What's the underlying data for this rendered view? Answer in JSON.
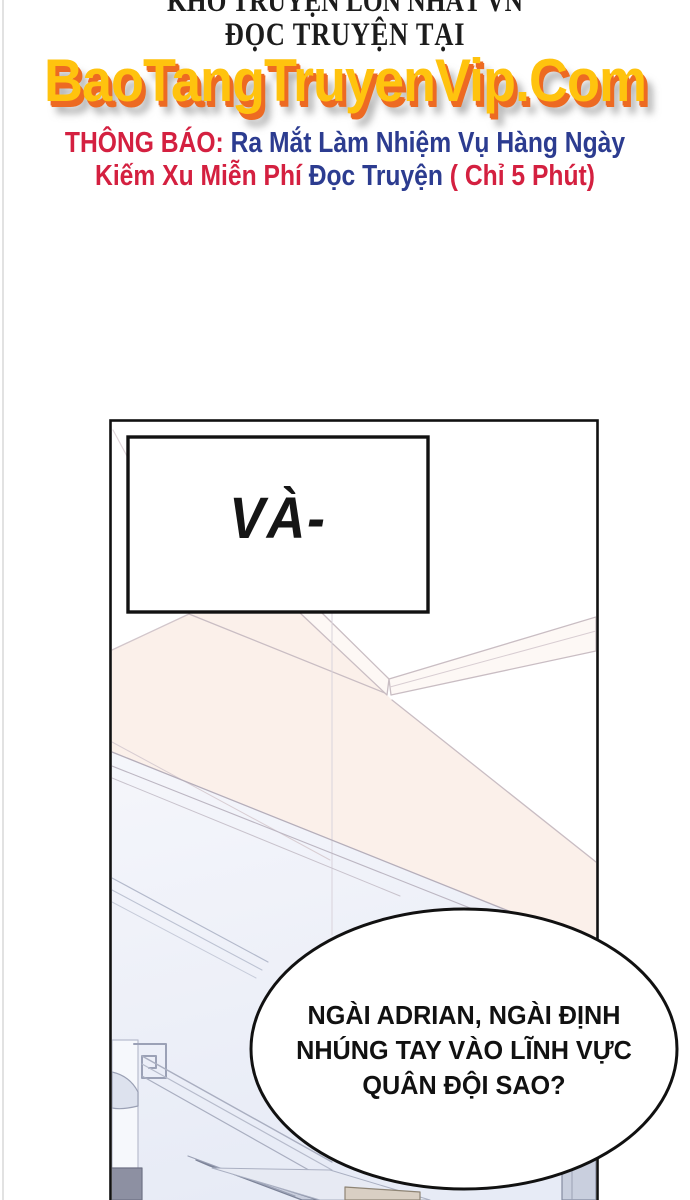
{
  "page": {
    "header": {
      "line1": "KHO TRUYỆN LỚN NHẤT VN",
      "line2": "ĐỌC TRUYỆN TẠI",
      "logo": "BaoTangTruyenVip.Com",
      "notice": {
        "label": "THÔNG BÁO: ",
        "line1_rest": "Ra Mắt Làm Nhiệm Vụ Hàng Ngày",
        "line2_red": "Kiếm Xu Miễn Phí ",
        "line2_blue": "Đọc Truyện ",
        "line2_red2": "( Chỉ 5 Phút)"
      }
    },
    "comic": {
      "caption": "VÀ-",
      "bubble": {
        "line1": "NGÀI ADRIAN, NGÀI ĐỊNH",
        "line2": "NHÚNG TAY VÀO LĨNH VỰC",
        "line3": "QUÂN ĐỘI SAO?"
      }
    },
    "colors": {
      "logo_yellow": "#ffc30e",
      "logo_orange": "#ed6a22",
      "notice_red": "#d42040",
      "notice_blue": "#2c3c90",
      "ink": "#111111",
      "ceiling_peach": "#fbf0ea",
      "wall_blue": "#eef1f9",
      "line_pink_grey": "#c9bdc3",
      "line_blue_grey": "#a9aec0"
    }
  }
}
